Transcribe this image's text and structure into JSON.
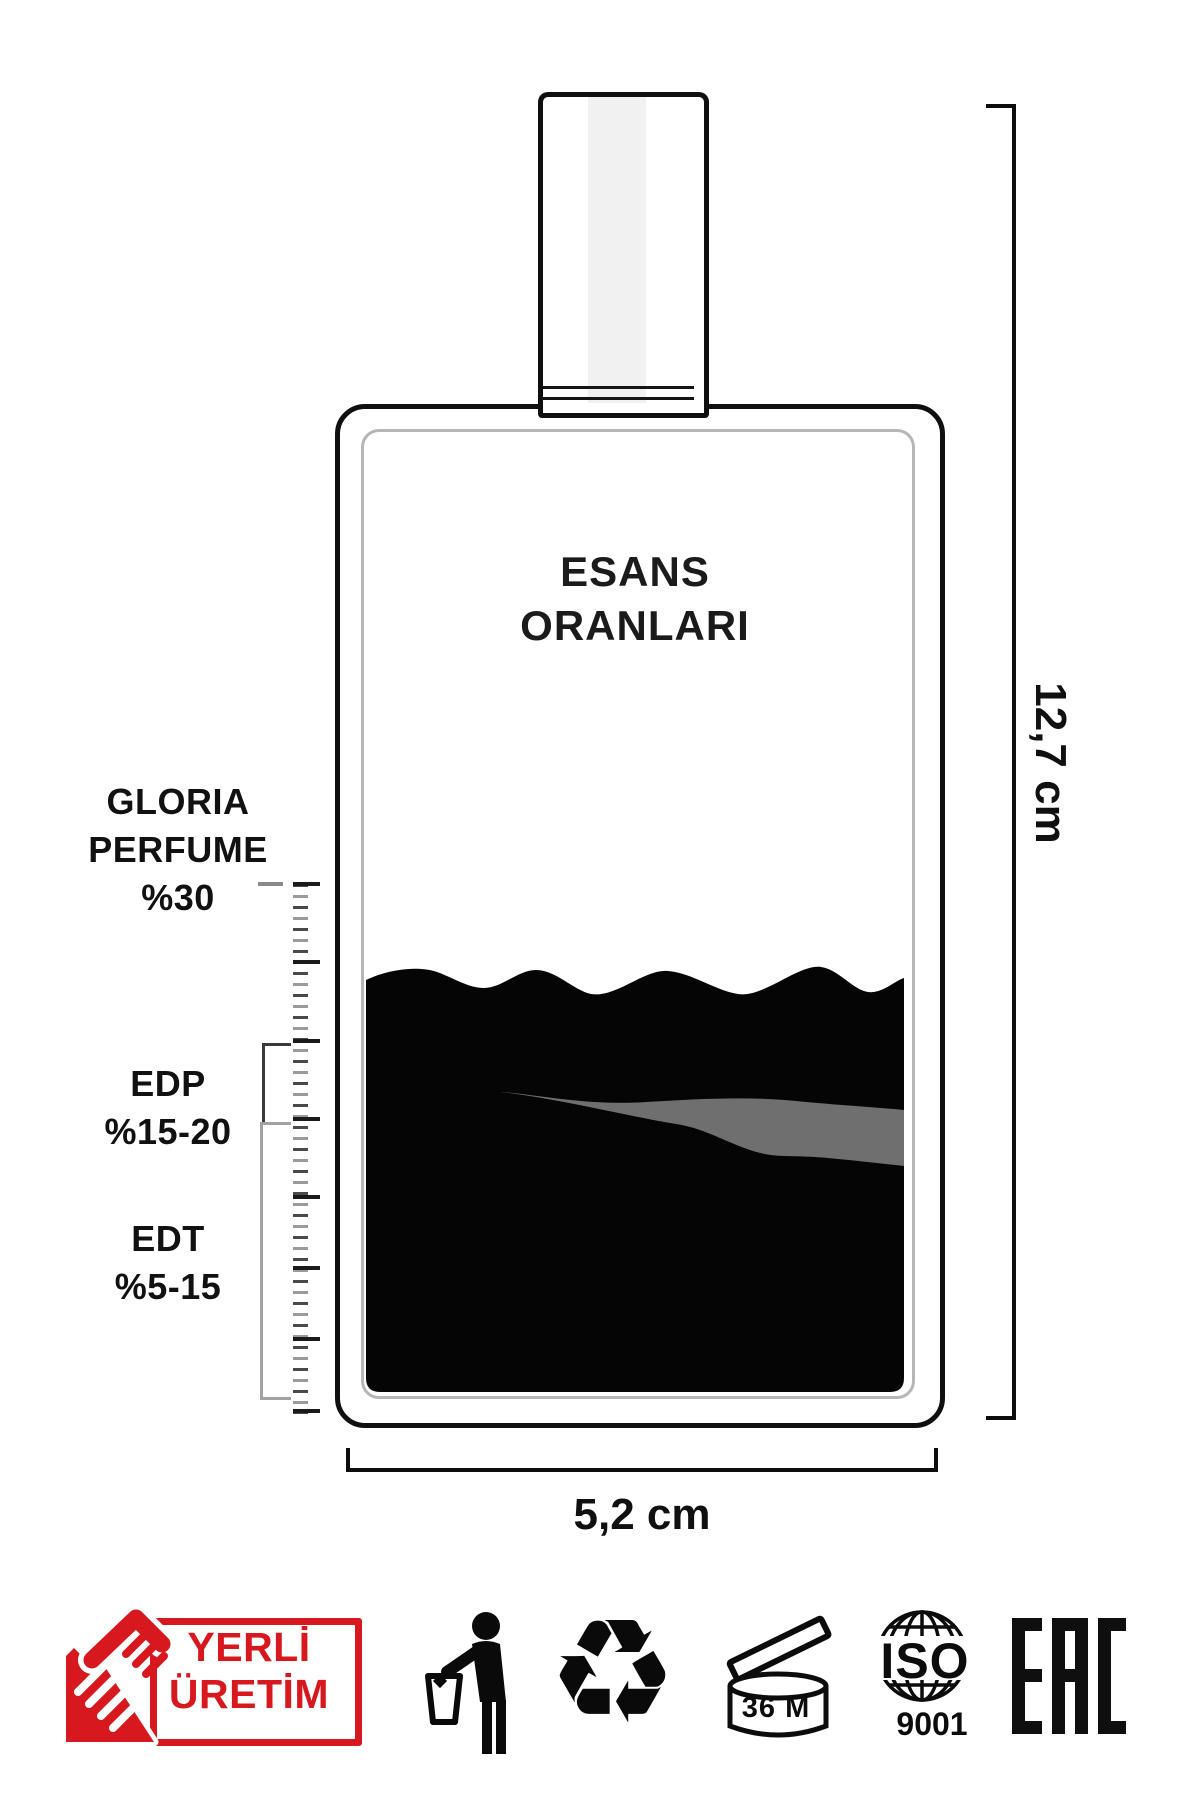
{
  "meta": {
    "accent_red": "#d7181f",
    "ink_black": "#0d0d0d",
    "liquid_black": "#050505",
    "streak_gray": "#6f6f6f",
    "inner_outline_gray": "#b6b6b6"
  },
  "bottle": {
    "title_line1": "ESANS",
    "title_line2": "ORANLARI"
  },
  "scale_labels": {
    "gloria": {
      "line1": "GLORIA",
      "line2": "PERFUME",
      "line3": "%30"
    },
    "edp": {
      "line1": "EDP",
      "line2": "%15-20"
    },
    "edt": {
      "line1": "EDT",
      "line2": "%5-15"
    }
  },
  "dimensions": {
    "height_label": "12,7 cm",
    "width_label": "5,2 cm"
  },
  "footer": {
    "badge": {
      "line1": "YERLİ",
      "line2": "ÜRETİM"
    },
    "recycle_symbol": "♻",
    "pao": {
      "label": "36 M"
    },
    "iso": {
      "title": "ISO",
      "number": "9001"
    },
    "eac": {
      "text": "EAC"
    }
  }
}
